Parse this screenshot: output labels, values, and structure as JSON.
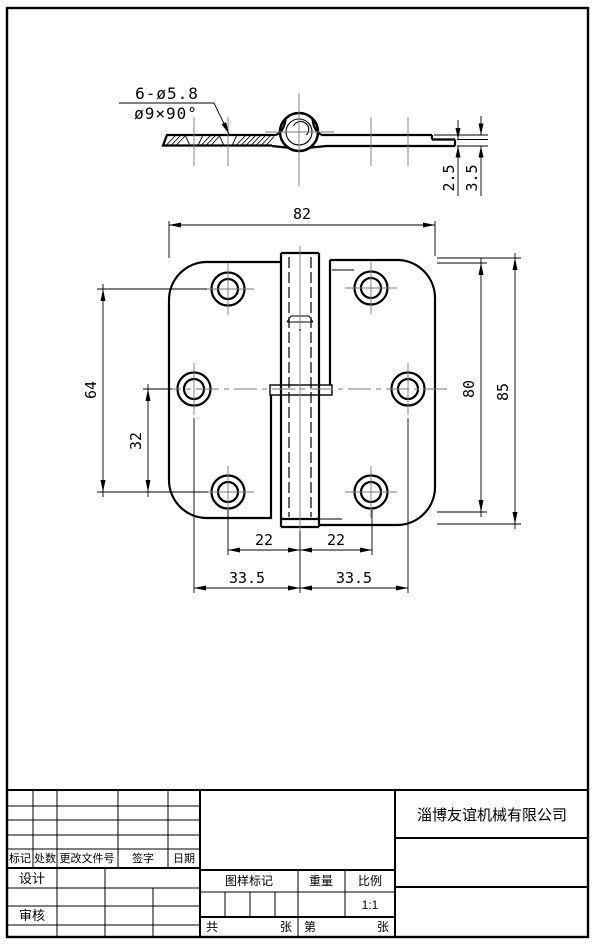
{
  "sheet": {
    "background": "#ffffff",
    "line_color": "#000000",
    "centerline_color": "#7a7a7a"
  },
  "side_view": {
    "note_line1": "6-ø5.8",
    "note_line2": "ø9×90°",
    "dim_thin": "2.5",
    "dim_total": "3.5"
  },
  "front_view": {
    "dim_width": "82",
    "dim_hole_span": "64",
    "dim_hole_half": "32",
    "dim_leaf_height": "80",
    "dim_total_height": "85",
    "dim_hole_left": "22",
    "dim_hole_right": "22",
    "dim_mid_left": "33.5",
    "dim_mid_right": "33.5"
  },
  "title_block": {
    "company": "淄博友谊机械有限公司",
    "col_mark": "标记",
    "col_qty": "处数",
    "col_doc": "更改文件号",
    "col_sign": "签字",
    "col_date": "日期",
    "row_design": "设计",
    "row_audit": "审核",
    "pattern_mark": "图样标记",
    "weight": "重量",
    "scale": "比例",
    "scale_value": "1:1",
    "sheets_total_label": "共",
    "sheets_total_unit": "张",
    "sheet_no_label": "第",
    "sheet_no_unit": "张"
  }
}
